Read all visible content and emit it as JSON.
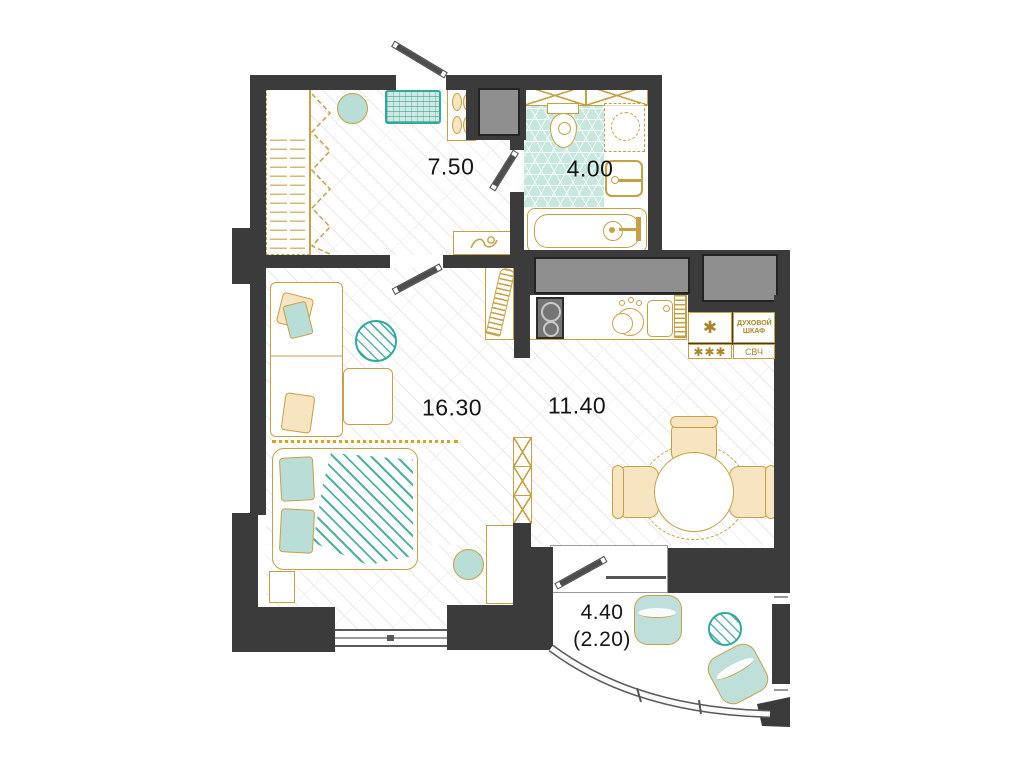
{
  "plan_title": "apartment floor plan",
  "rooms": [
    {
      "name": "hallway",
      "area": "7.50"
    },
    {
      "name": "bathroom",
      "area": "4.00"
    },
    {
      "name": "living-room",
      "area": "16.30"
    },
    {
      "name": "kitchen",
      "area": "11.40"
    },
    {
      "name": "balcony",
      "area": "4.40",
      "area_reduced": "(2.20)"
    }
  ],
  "kitchen_appliances": {
    "fridge_symbol": "✱",
    "freezer_symbol": "✱✱✱",
    "oven_label": "ДУХОВОЙ ШКАФ",
    "microwave_label": "СВЧ"
  },
  "colors": {
    "walls": "#3b3b3b",
    "furniture_outline": "#c7a043",
    "accent_teal": "#2fa99a",
    "accent_teal_fill": "#b9ded7",
    "shaft_gray": "#8f8f8f",
    "label_text": "#141414"
  }
}
